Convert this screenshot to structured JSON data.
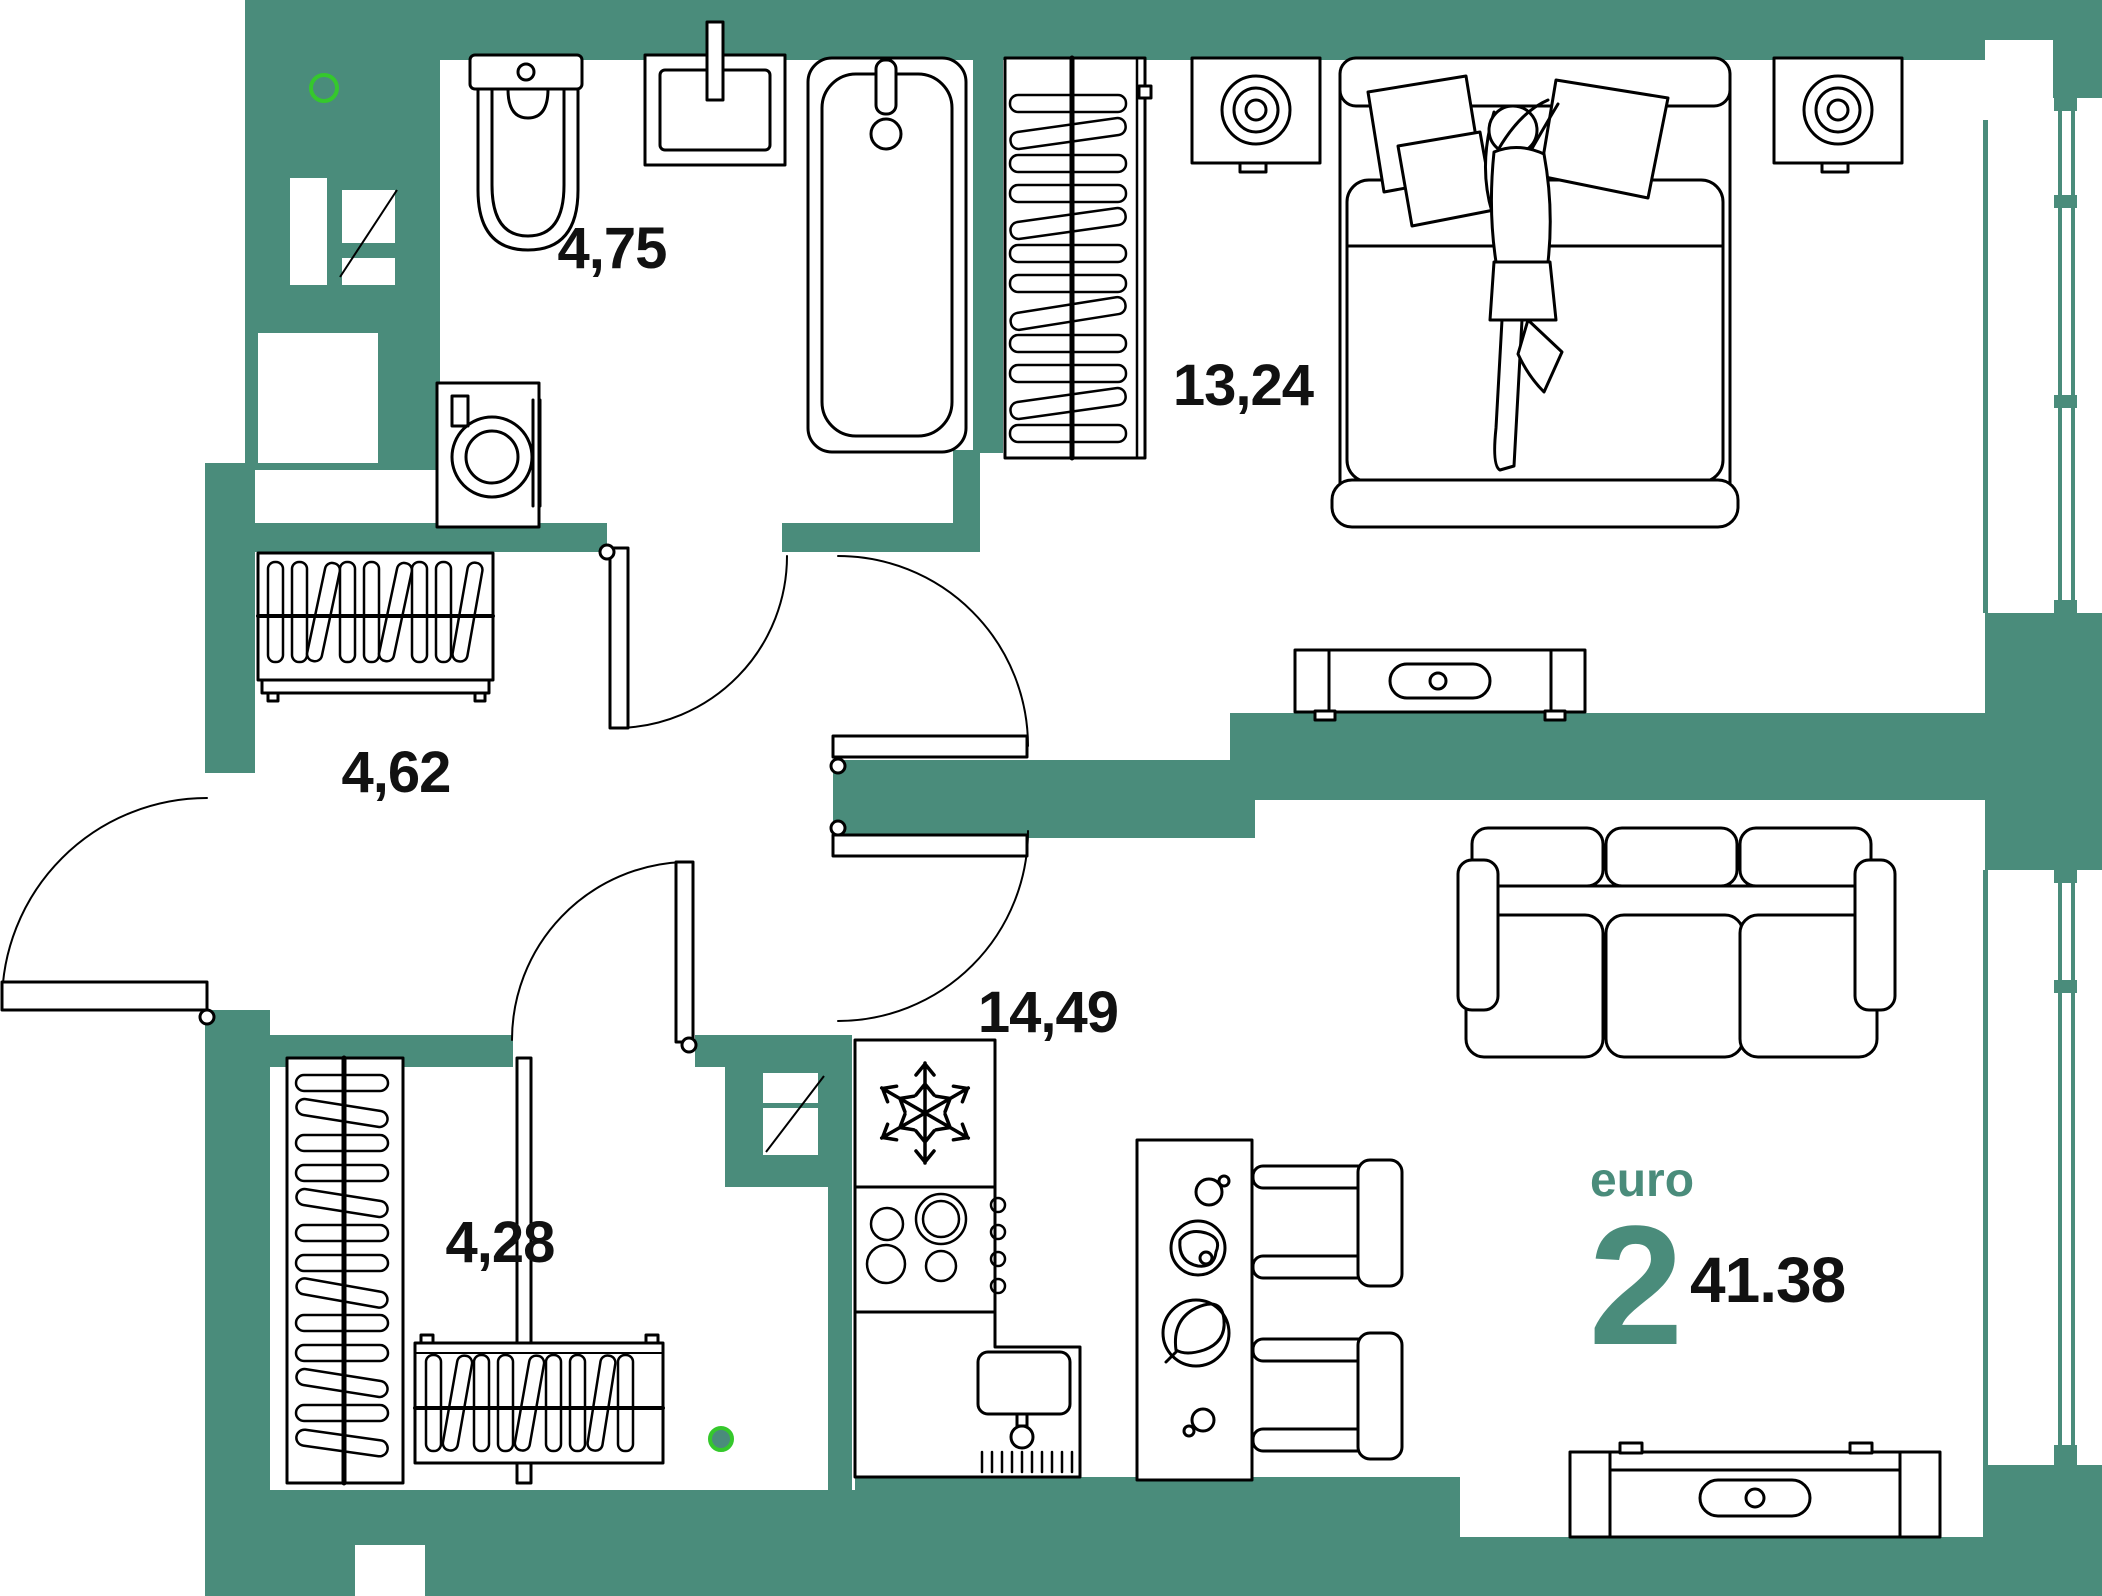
{
  "plan": {
    "unit": {
      "type_label": "euro",
      "rooms_badge": "2",
      "total_area": "41.38"
    },
    "rooms": [
      {
        "name": "bathroom",
        "area": "4,75"
      },
      {
        "name": "bedroom",
        "area": "13,24"
      },
      {
        "name": "hallway",
        "area": "4,62"
      },
      {
        "name": "wardrobe-room",
        "area": "4,28"
      },
      {
        "name": "kitchen-living",
        "area": "14,49"
      }
    ],
    "colors": {
      "wall": "#4A8C7B",
      "furniture_line": "#000000",
      "marker_green": "#35C82C",
      "text": "#111111",
      "accent_text": "#4A8C7B",
      "background": "#FFFFFF"
    },
    "icons": {
      "snowflake-icon": "fridge symbol",
      "hanger-icon": "wardrobe rail hangers",
      "door-arc-icon": "door swing arc",
      "green-dot-icon": "entry point marker"
    }
  }
}
